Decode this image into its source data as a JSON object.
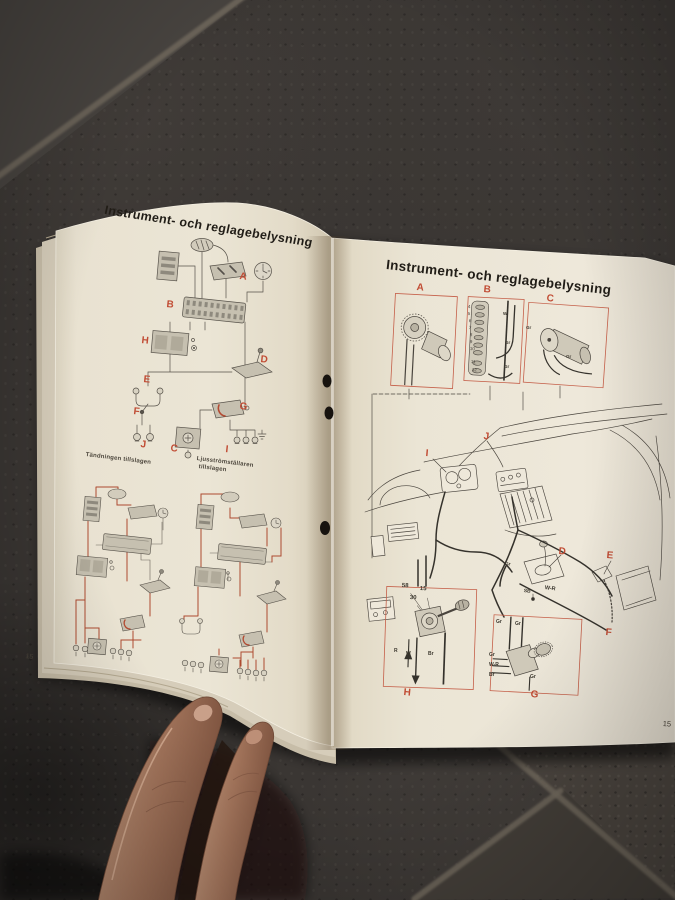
{
  "scene": {
    "colors": {
      "label_red": "#c14c34",
      "wire_red": "#ad4a30",
      "page": "#eae4d4",
      "tile": "#3a3633"
    }
  },
  "left_page": {
    "title": "Instrument- och reglagebelysning",
    "page_number": "15",
    "caption_ignition": "Tändningen tillslagen",
    "caption_lightswitch_line1": "Ljusströmställaren",
    "caption_lightswitch_line2": "tillslagen",
    "labels": {
      "a": "A",
      "b": "B",
      "c": "C",
      "d": "D",
      "e": "E",
      "f": "F",
      "g": "G",
      "h": "H",
      "i": "I",
      "j": "J"
    }
  },
  "right_page": {
    "title": "Instrument- och reglagebelysning",
    "page_number": "15",
    "labels": {
      "a": "A",
      "b": "B",
      "c": "C",
      "d": "D",
      "e": "E",
      "f": "F",
      "g": "G",
      "h": "H",
      "i": "I",
      "j": "J"
    },
    "fuse_numbers": [
      "4",
      "5",
      "6",
      "7",
      "8",
      "9",
      "10",
      "11",
      "12"
    ],
    "ignition_terminals": {
      "t58": "58",
      "t30": "30",
      "t15": "15"
    },
    "wire_labels": {
      "r": "R",
      "w": "W",
      "br": "Br",
      "gr": "Gr",
      "w_r": "W-R",
      "sb": "SB"
    }
  }
}
